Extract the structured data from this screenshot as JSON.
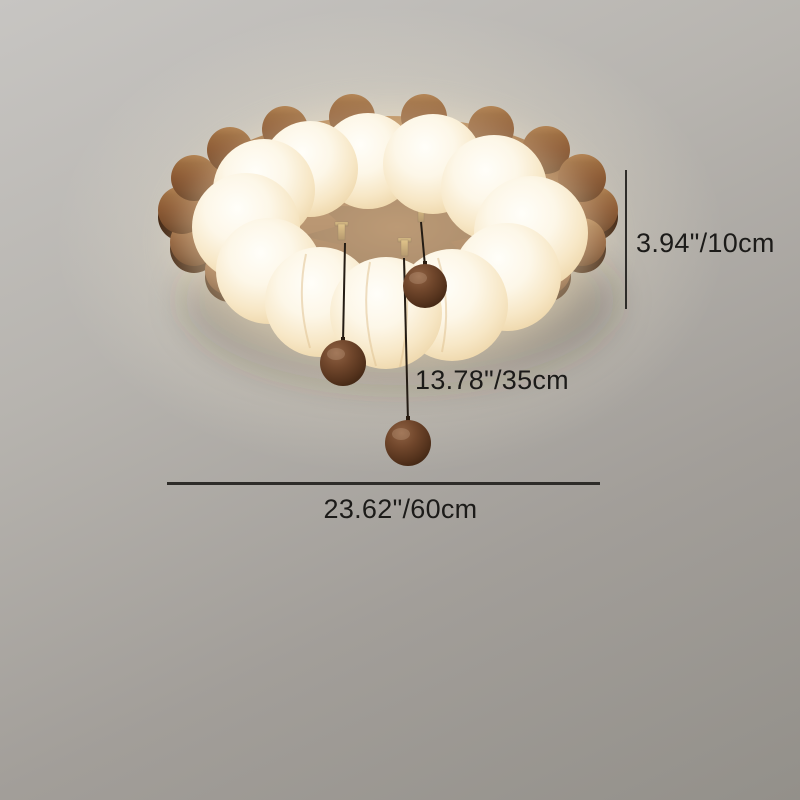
{
  "scene": {
    "description": "Product dimension photo of a wooden scalloped flush-mount ceiling lamp with white pumpkin LED ring and three hanging walnut balls"
  },
  "annotations": {
    "height_label": "3.94\"/10cm",
    "drop_label": "13.78\"/35cm",
    "width_label": "23.62\"/60cm"
  },
  "colors": {
    "background_top": "#c7c5c2",
    "background_bottom": "#93908a",
    "dimension_line": "#2e2c29",
    "dimension_text": "#1c1b19",
    "plate_wood": "#8a5731",
    "plate_wood_dark": "#3f2310",
    "shade_white": "#fffef9",
    "shade_warm": "#ecd3a4",
    "ball_wood": "#71472c",
    "cord": "#241c14",
    "brass": "#c8a256"
  }
}
